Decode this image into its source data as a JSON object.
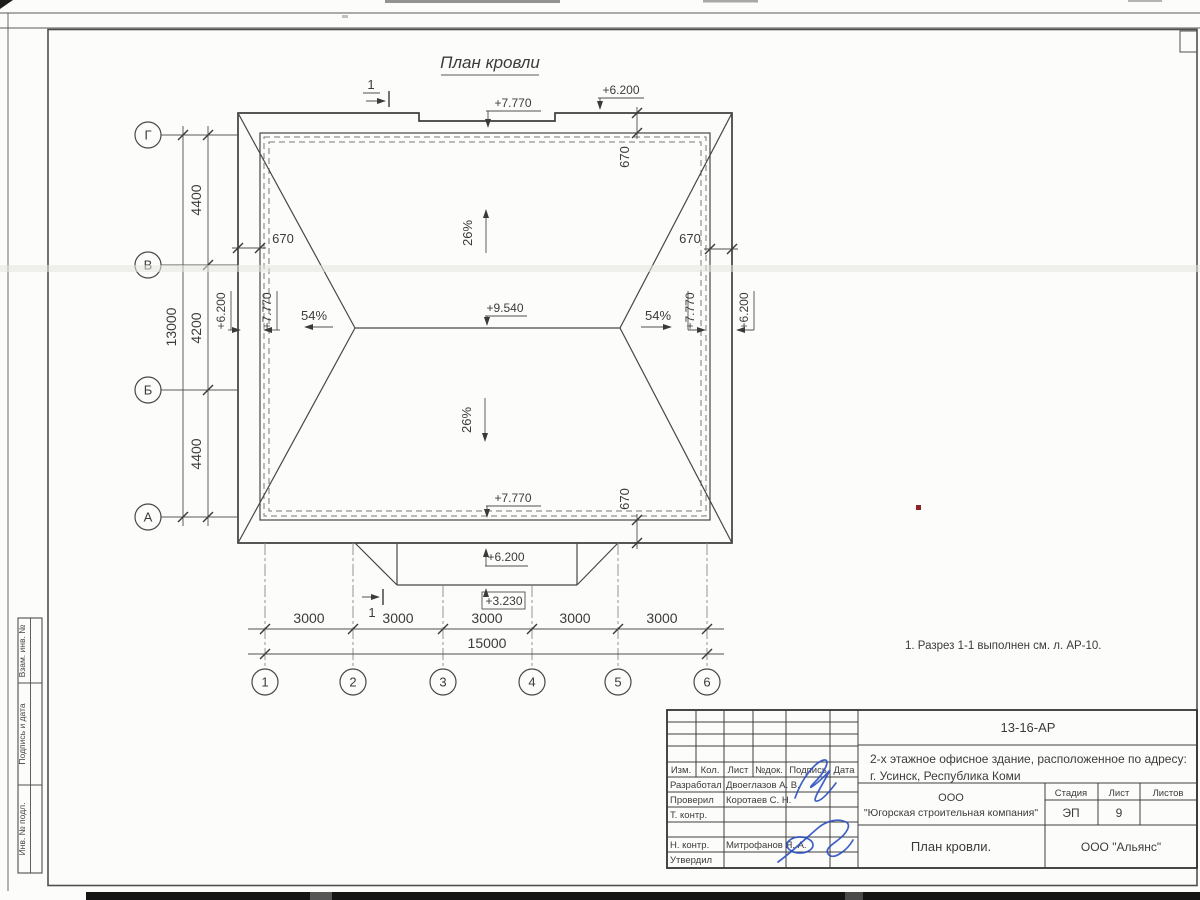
{
  "sheet": {
    "title": "План кровли",
    "note": "1. Разрез 1-1 выполнен см. л. АР-10."
  },
  "axes": {
    "rows": [
      "Г",
      "В",
      "Б",
      "А"
    ],
    "cols": [
      "1",
      "2",
      "3",
      "4",
      "5",
      "6"
    ]
  },
  "dims": {
    "row_segments": [
      "4400",
      "4200",
      "4400"
    ],
    "row_total": "13000",
    "col_segments": [
      "3000",
      "3000",
      "3000",
      "3000",
      "3000"
    ],
    "col_total": "15000",
    "eave_overhangs": [
      "670",
      "670",
      "670",
      "670"
    ]
  },
  "elevations": {
    "eave_top": "+7.770",
    "parapet_top": "+6.200",
    "ridge": "+9.540",
    "eave_bottom": "+7.770",
    "canopy_top": "+6.200",
    "canopy_edge": "+3.230",
    "left_parapet": "+6.200",
    "left_eave": "+7.770",
    "right_eave": "+7.770",
    "right_parapet": "+6.200"
  },
  "slopes": {
    "north": "26%",
    "south": "26%",
    "west": "54%",
    "east": "54%"
  },
  "section": {
    "label": "1"
  },
  "titleblock": {
    "doc_number": "13-16-АР",
    "project_address_line1": "2-х этажное офисное здание, расположенное по адресу:",
    "project_address_line2": "г. Усинск, Республика Коми",
    "org_line1": "ООО",
    "org_line2": "\"Югорская строительная компания\"",
    "sheet_name": "План кровли.",
    "contractor": "ООО \"Альянс\"",
    "stage_label": "Стадия",
    "sheet_label": "Лист",
    "sheets_label": "Листов",
    "stage_value": "ЭП",
    "sheet_value": "9",
    "header_cols": [
      "Изм.",
      "Кол.",
      "Лист",
      "№док.",
      "Подпись",
      "Дата"
    ],
    "roles": [
      {
        "role": "Разработал",
        "name": "Двоеглазов А. В."
      },
      {
        "role": "Проверил",
        "name": "Коротаев С. Н."
      },
      {
        "role": "Т. контр.",
        "name": ""
      },
      {
        "role": "Н. контр.",
        "name": "Митрофанов Я. А."
      },
      {
        "role": "Утвердил",
        "name": ""
      }
    ]
  },
  "margin_stamps": [
    "Взам. инв. №",
    "Подпись и дата",
    "Инв. № подл."
  ]
}
